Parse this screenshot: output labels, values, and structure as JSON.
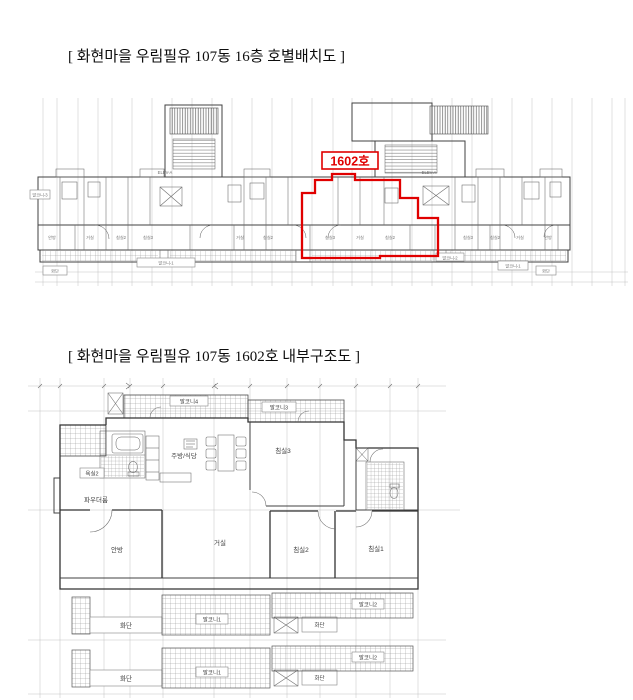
{
  "page": {
    "title1": "[ 화현마을 우림필유 107동 16층 호별배치도 ]",
    "title2": "[ 화현마을 우림필유 107동 1602호 내부구조도 ]"
  },
  "colors": {
    "highlight_red": "#e00000",
    "wall": "#404040",
    "grid": "#bcbcbc"
  },
  "top_plan": {
    "unit_label": "1602호",
    "elevator_label": "ELEV-A",
    "tiny_labels": [
      "안방",
      "거실",
      "침실2",
      "침실3",
      "거실",
      "침실2",
      "침실3",
      "거실",
      "침실2",
      "침실3",
      "침실2",
      "거실",
      "안방"
    ],
    "bottom_labels": {
      "flower_bed": "화단",
      "balcony_1": "발코니-1",
      "balcony_2": "발코니-2",
      "balcony_3": "발코니-3"
    }
  },
  "bottom_plan": {
    "rooms": {
      "balcony4": "발코니4",
      "balcony3": "발코니3",
      "bath2": "욕실2",
      "powder": "파우더룸",
      "kitchen": "주방/식당",
      "bed3": "침실3",
      "master": "안방",
      "living": "거실",
      "bed2": "침실2",
      "bed1": "침실1",
      "balcony1": "발코니1",
      "balcony2": "발코니2",
      "flower_bed": "화단"
    }
  }
}
